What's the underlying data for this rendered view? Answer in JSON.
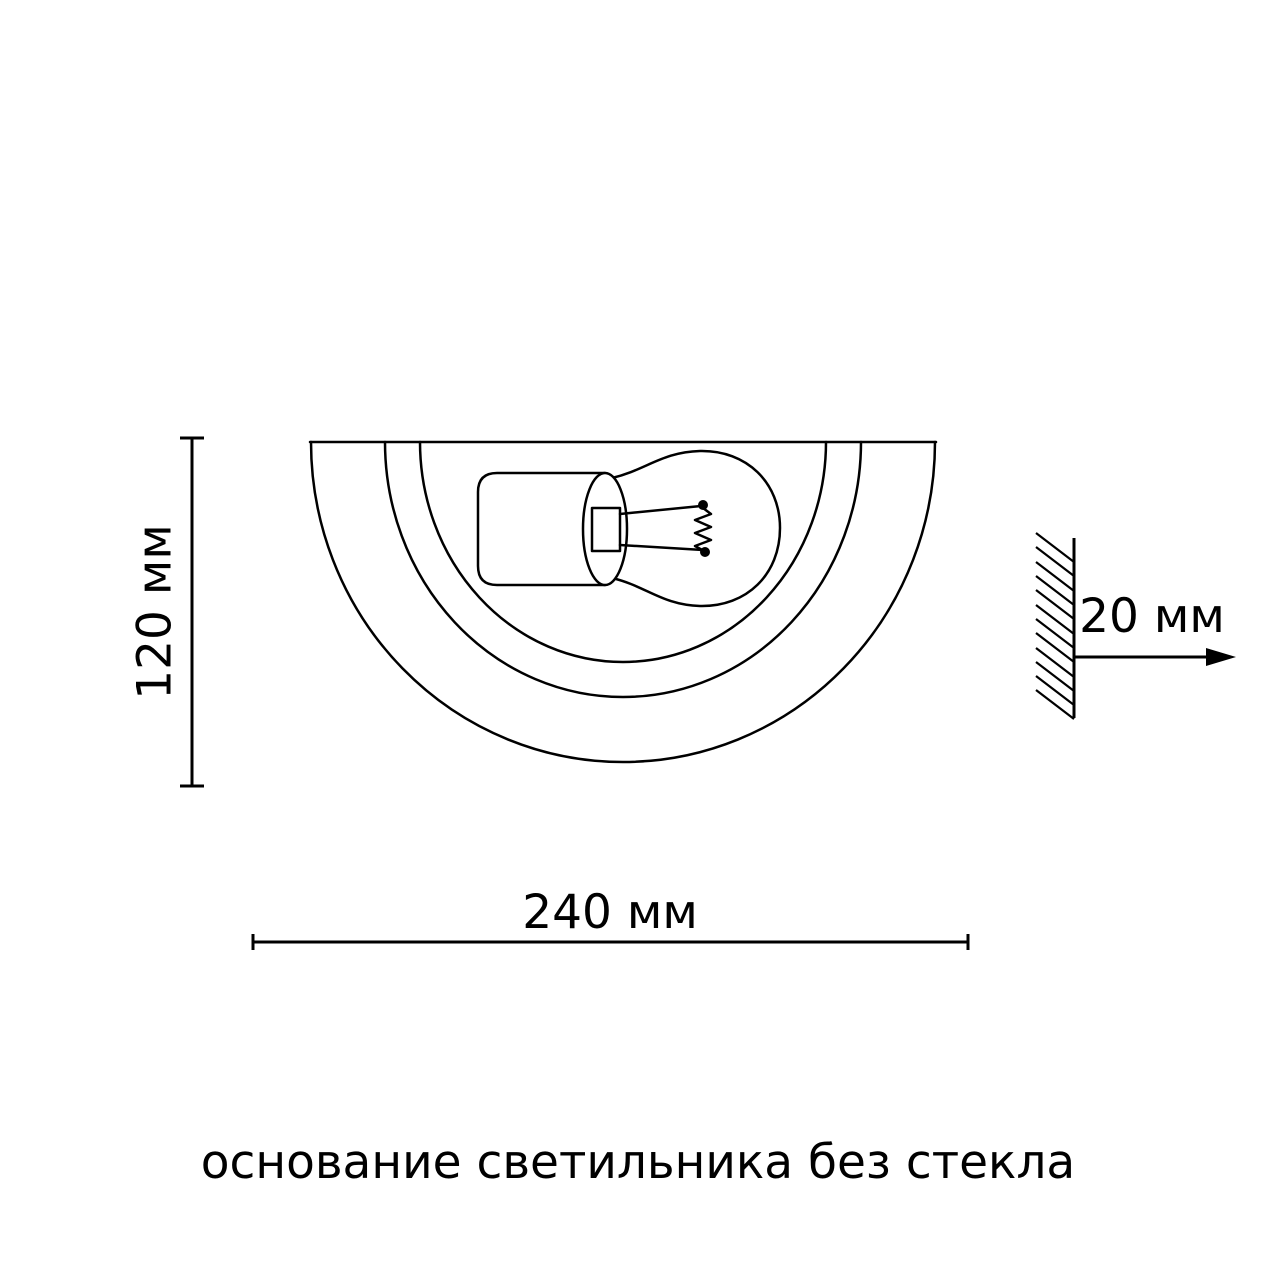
{
  "diagram": {
    "caption": "основание светильника без стекла",
    "dimensions": {
      "height_label": "120 мм",
      "width_label": "240 мм",
      "wall_offset_label": "20 мм"
    },
    "colors": {
      "line": "#000000",
      "background": "#ffffff"
    }
  }
}
